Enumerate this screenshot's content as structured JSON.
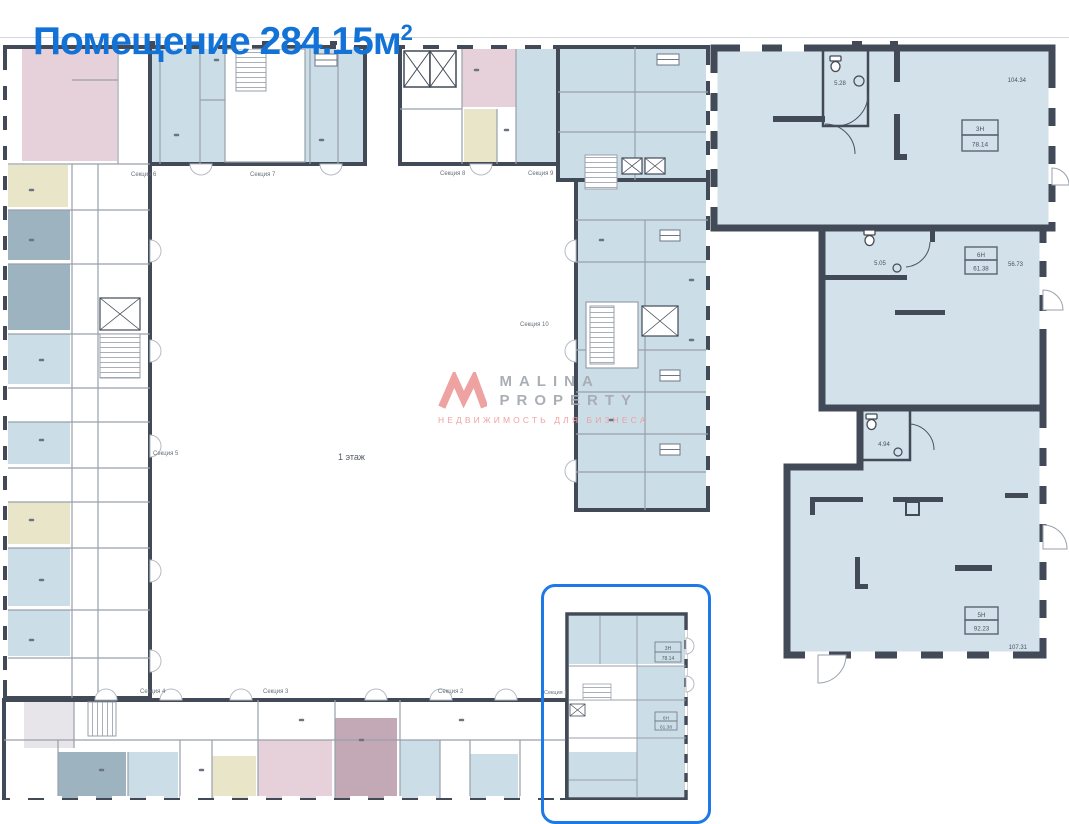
{
  "title": {
    "main": "Помещение 284.15м",
    "sup": "2"
  },
  "plan": {
    "floor_label": "1 этаж",
    "sections": {
      "s1": "Секция 1",
      "s2": "Секция 2",
      "s3": "Секция 3",
      "s4": "Секция 4",
      "s5": "Секция 5",
      "s6": "Секция 6",
      "s7": "Секция 7",
      "s8": "Секция 8",
      "s9": "Секция 9",
      "s10": "Секция 10"
    }
  },
  "watermark": {
    "brand_top": "MALINA",
    "brand_bottom": "PROPERTY",
    "tagline": "НЕДВИЖИМОСТЬ ДЛЯ БИЗНЕСА"
  },
  "detail": {
    "room3": {
      "id": "3Н",
      "area": "78.14",
      "dim": "104.34",
      "wc": "5.28"
    },
    "room6": {
      "id": "6Н",
      "area": "61.38",
      "dim": "56.73",
      "wc": "5.05"
    },
    "room5": {
      "id": "5Н",
      "area": "92.23",
      "dim": "107.31",
      "wc": "4.94"
    }
  },
  "mini": {
    "room3_id": "3Н",
    "room3_area": "78.14",
    "room6_id": "6Н",
    "room6_area": "61.38"
  },
  "colors": {
    "accent_blue": "#1272d6",
    "highlight_border": "#1d79e8",
    "wall": "#424a57",
    "room_blue": "#cbdde7",
    "detail_blue": "#d2e1ea",
    "pink": "#e6d1db",
    "yellow": "#e8e5c8",
    "slate_blue": "#9db3c0",
    "mauve": "#c2a9b5",
    "logo_salmon": "#ee9f9e",
    "brand_gray": "#a7acb4"
  }
}
